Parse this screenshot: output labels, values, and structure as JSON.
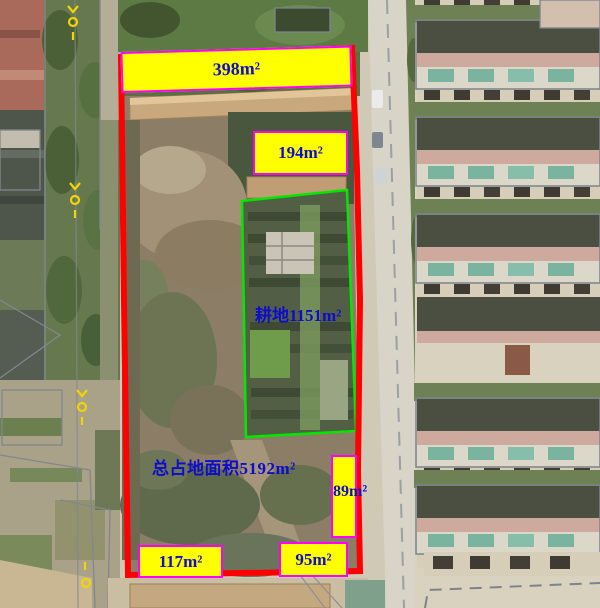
{
  "annotations": {
    "area_top": "398m²",
    "area_upper": "194m²",
    "farmland": "耕地1151m²",
    "total_area": "总占地面积5192m²",
    "area_right": "89m²",
    "area_bottom_left": "117m²",
    "area_bottom_right": "95m²"
  },
  "colors": {
    "parcel_boundary": "#ff0000",
    "farmland_boundary": "#00e800",
    "label_background": "#ffff00",
    "label_border": "#ff00fe",
    "label_text": "#0d0dcb",
    "survey_marker": "#f2d400"
  }
}
